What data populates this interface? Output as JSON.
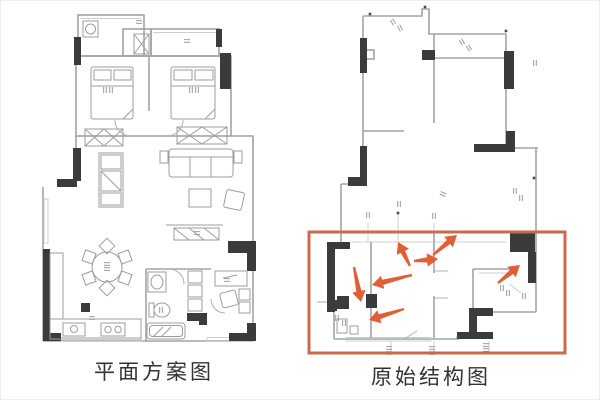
{
  "page": {
    "width": 600,
    "height": 400,
    "background": "#ffffff"
  },
  "left_plan": {
    "caption": "平面方案图",
    "kind": "furnished layout plan"
  },
  "right_plan": {
    "caption": "原始结构图",
    "kind": "original structure plan"
  },
  "plan_colors": {
    "wall_black": "#3b3b3b",
    "line_gray": "#a3a3a3",
    "window_gray": "#cfcfcf"
  },
  "annotations": {
    "highlight_box": {
      "x": 308,
      "y": 231,
      "width": 256,
      "height": 121,
      "color": "#c96a4e",
      "stroke_width": 3
    },
    "arrow_color": "#e25f36",
    "arrows": [
      {
        "tail_x": 409,
        "tail_y": 265,
        "tip_x": 397,
        "tip_y": 241,
        "direction": "up"
      },
      {
        "tail_x": 413,
        "tail_y": 260,
        "tip_x": 437,
        "tip_y": 258,
        "direction": "right"
      },
      {
        "tail_x": 432,
        "tail_y": 254,
        "tip_x": 456,
        "tip_y": 234,
        "direction": "up-right"
      },
      {
        "tail_x": 411,
        "tail_y": 274,
        "tip_x": 371,
        "tip_y": 284,
        "direction": "left"
      },
      {
        "tail_x": 353,
        "tail_y": 266,
        "tip_x": 360,
        "tip_y": 301,
        "direction": "down"
      },
      {
        "tail_x": 403,
        "tail_y": 308,
        "tip_x": 368,
        "tip_y": 319,
        "direction": "left"
      },
      {
        "tail_x": 497,
        "tail_y": 282,
        "tip_x": 519,
        "tip_y": 264,
        "direction": "up-right"
      }
    ]
  },
  "dimension_marks": {
    "right": [
      [
        392,
        21,
        60
      ],
      [
        399,
        27,
        60
      ],
      [
        461,
        41,
        60
      ],
      [
        468,
        47,
        60
      ],
      [
        534,
        62,
        90
      ],
      [
        514,
        190,
        90
      ],
      [
        520,
        197,
        90
      ],
      [
        442,
        193,
        25
      ],
      [
        336,
        317,
        90
      ],
      [
        343,
        322,
        90
      ],
      [
        388,
        347,
        0
      ],
      [
        388,
        352,
        0
      ],
      [
        431,
        347,
        0
      ],
      [
        431,
        352,
        0
      ],
      [
        485,
        344,
        0
      ],
      [
        485,
        349,
        0
      ],
      [
        501,
        287,
        90
      ],
      [
        507,
        292,
        90
      ],
      [
        523,
        295,
        90
      ],
      [
        367,
        214,
        90
      ],
      [
        398,
        203,
        90
      ],
      [
        433,
        215,
        90
      ]
    ],
    "left": [
      [
        104,
        89,
        90
      ],
      [
        110,
        89,
        90
      ],
      [
        190,
        89,
        90
      ],
      [
        196,
        89,
        90
      ],
      [
        106,
        263,
        0
      ],
      [
        106,
        268,
        0
      ],
      [
        138,
        21,
        0
      ],
      [
        186,
        40,
        0
      ],
      [
        91,
        317,
        0
      ],
      [
        160,
        309,
        90
      ],
      [
        226,
        279,
        0
      ],
      [
        196,
        232,
        0
      ]
    ]
  },
  "marker_dots": [
    [
      397,
      212
    ],
    [
      424,
      6
    ],
    [
      369,
      13
    ],
    [
      533,
      177
    ],
    [
      505,
      30
    ],
    [
      457,
      336
    ]
  ]
}
